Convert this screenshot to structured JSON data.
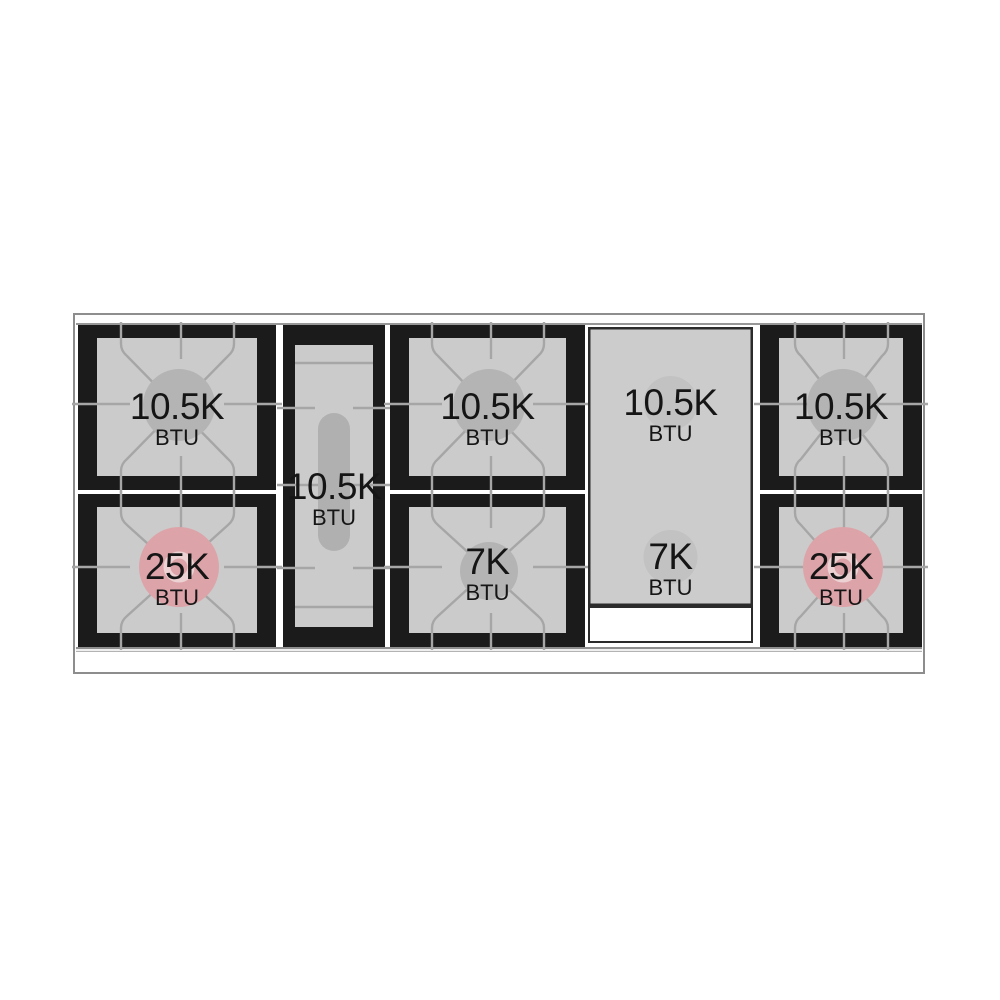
{
  "figure": {
    "kind": "gas-rangetop-burner-power-diagram",
    "unit_label": "BTU"
  },
  "colors": {
    "frame": "#1b1b1b",
    "grate_bg": "#cbcbcb",
    "grate_line": "#a6a6a6",
    "cap_gray": "#b4b4b4",
    "cap_pink": "#dca4a9",
    "cap_pink_ring": "#edd2d4",
    "griddle_bg": "#cccccc",
    "griddle_border": "#2b2b2b",
    "griddle_cap": "#c2c2c2",
    "text": "#151515"
  },
  "burners": {
    "left_top": {
      "power": "10.5K",
      "unit": "BTU"
    },
    "left_bottom": {
      "power": "25K",
      "unit": "BTU"
    },
    "center_oval": {
      "power": "10.5K",
      "unit": "BTU"
    },
    "middle_top": {
      "power": "10.5K",
      "unit": "BTU"
    },
    "middle_bottom": {
      "power": "7K",
      "unit": "BTU"
    },
    "griddle_top": {
      "power": "10.5K",
      "unit": "BTU"
    },
    "griddle_bottom": {
      "power": "7K",
      "unit": "BTU"
    },
    "right_top": {
      "power": "10.5K",
      "unit": "BTU"
    },
    "right_bottom": {
      "power": "25K",
      "unit": "BTU"
    }
  }
}
